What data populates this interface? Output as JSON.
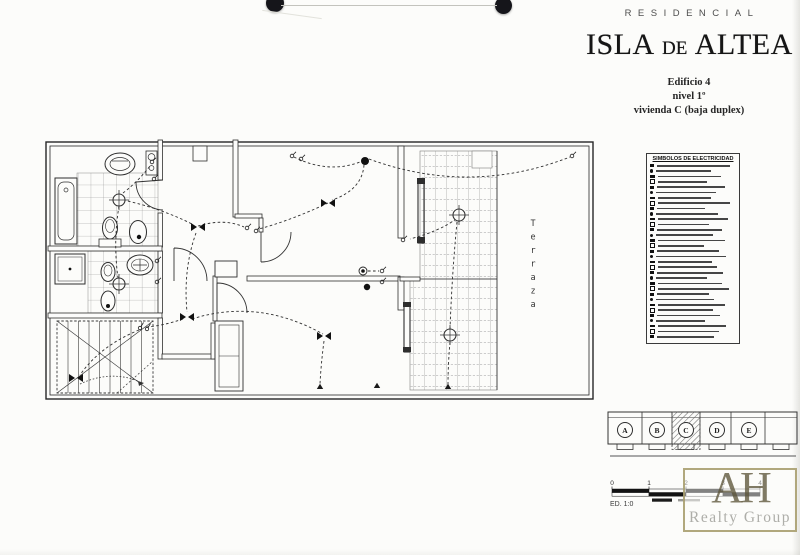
{
  "header": {
    "brand": "RESIDENCIAL",
    "title_part1": "ISLA",
    "title_de": "DE",
    "title_part2": "ALTEA",
    "building": "Edificio 4",
    "level": "nivel 1º",
    "unit": "vivienda C (baja duplex)"
  },
  "legend": {
    "title": "SIMBOLOS DE ELECTRICIDAD",
    "row_count": 33
  },
  "plan": {
    "terrace_label": "Terraza"
  },
  "keyplan": {
    "units": [
      "A",
      "B",
      "C",
      "D",
      "E"
    ],
    "highlighted_unit": "C"
  },
  "scalebar": {
    "labels": [
      "0",
      "1",
      "2",
      "3",
      "4"
    ],
    "caption": "ED. 1:0"
  },
  "watermark": {
    "initials": "AH",
    "name": "Realty Group"
  },
  "colors": {
    "ink": "#2e2e2e",
    "tile_line": "#8d8d8d",
    "watermark_border": "#a3996a",
    "watermark_initials": "#5c553a",
    "watermark_name": "#aaaaa4"
  }
}
